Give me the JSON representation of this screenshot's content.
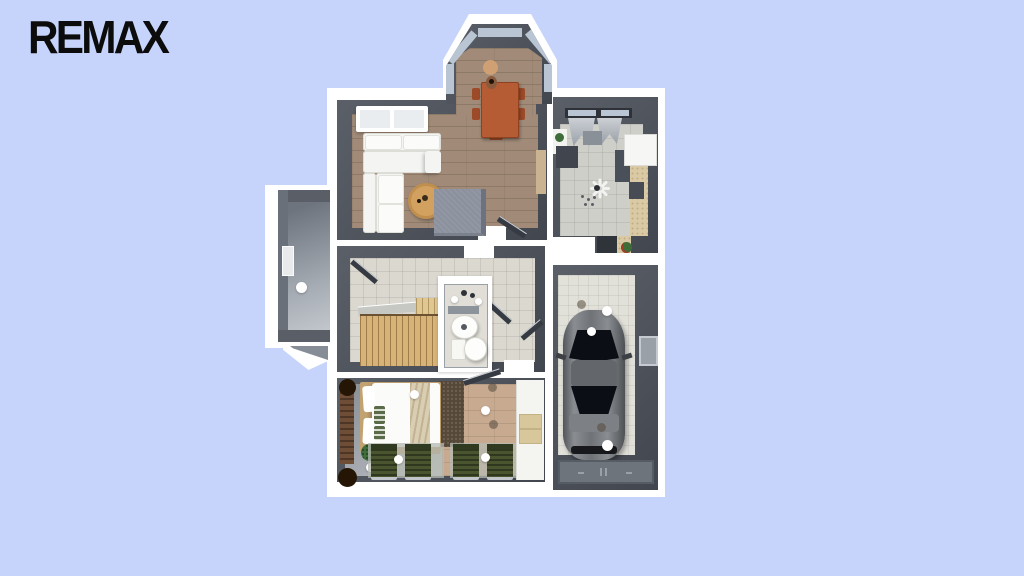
{
  "logo": {
    "text": "REMAX",
    "color": "#0c0c0c"
  },
  "scene": {
    "type": "3d-floor-plan-render",
    "rooms": [
      "entry",
      "living-room",
      "dining-bay",
      "kitchen",
      "hallway",
      "bathroom",
      "bedroom",
      "garage"
    ],
    "objects": [
      "corner-sofa",
      "picture-window",
      "round-coffee-table",
      "gray-ottoman-rug",
      "dining-table",
      "dining-chairs",
      "vase",
      "kitchen-window",
      "curtains",
      "kitchen-counters",
      "ceiling-fan",
      "staircase",
      "open-doors",
      "wash-basin",
      "toilet",
      "double-bed",
      "pillows",
      "shag-rug",
      "sun-loungers",
      "potted-plants",
      "wardrobe",
      "car",
      "garage-door",
      "ceiling-lights"
    ]
  },
  "palette": {
    "bg": "#c6d4fb",
    "white": "#ffffff",
    "wall": "#4d525b",
    "wood": "#a18b78",
    "tile": "#dbd8d0",
    "ktile": "#cfcfc9",
    "gtile": "#e2e1d9",
    "bwood": "#c8aa90",
    "stairs": "#d7b377",
    "shag": "#57493a",
    "lounger": "#4a5530",
    "counter": "#d9c9a4",
    "table": "#b55c34",
    "chair": "#9c4a28",
    "ctable": "#d2a15f",
    "sofa": "#f4f4f2",
    "rug": "#8b919d",
    "car": "#717478",
    "glass": "#0b0f15",
    "door": "#6e747c",
    "winblue": "#b9c5d3",
    "green": "#3e6d3a",
    "pot": "#241505",
    "tan": "#c3a272",
    "blanket": "#d9cdb2",
    "closetbox": "#d9c79c"
  }
}
